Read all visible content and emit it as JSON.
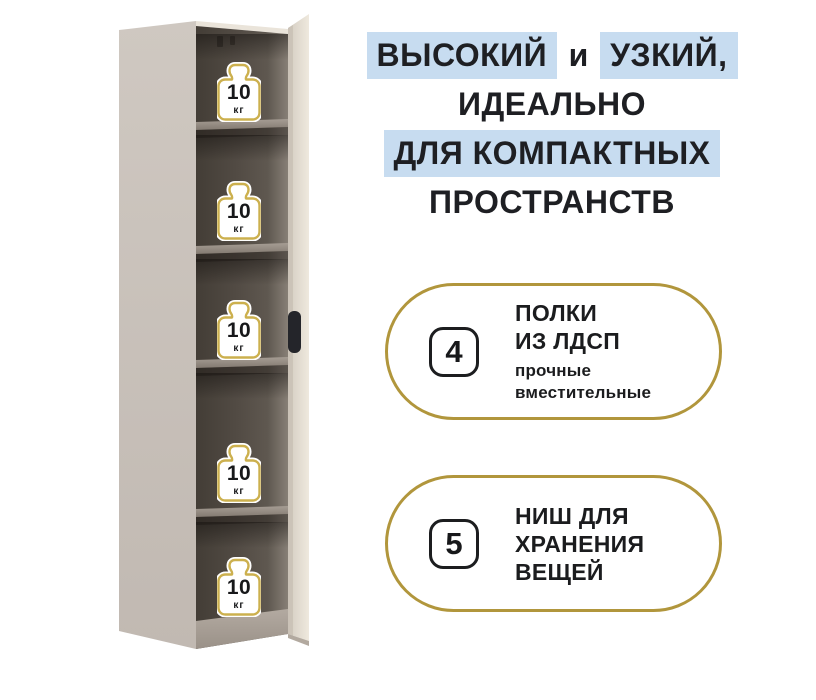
{
  "page": {
    "background_color": "#ffffff",
    "accent_gold": "#b1963c",
    "highlight_blue": "#c7dcf0",
    "text_color": "#1e1f23"
  },
  "headline": {
    "segments": [
      {
        "text": "ВЫСОКИЙ",
        "highlighted": true
      },
      {
        "text": "и",
        "highlighted": false
      },
      {
        "text": "УЗКИЙ,",
        "highlighted": true
      },
      {
        "text": "ИДЕАЛЬНО",
        "highlighted": false
      },
      {
        "text": "ДЛЯ КОМПАКТНЫХ",
        "highlighted": true
      },
      {
        "text": "ПРОСТРАНСТВ",
        "highlighted": false
      }
    ]
  },
  "features": [
    {
      "count": "4",
      "title_lines": [
        "ПОЛКИ",
        "ИЗ ЛДСП"
      ],
      "subtitle_lines": [
        "прочные",
        "вместительные"
      ]
    },
    {
      "count": "5",
      "title_lines": [
        "НИШ ДЛЯ",
        "ХРАНЕНИЯ",
        "ВЕЩЕЙ"
      ],
      "subtitle_lines": []
    }
  ],
  "cabinet": {
    "colors": {
      "side_panel": "#c9c1ba",
      "door": "#e9e3d8",
      "interior_dark": "#433d36",
      "interior_light": "#877f76",
      "handle": "#24252a",
      "weight_outline_gold": "#ccb04e"
    },
    "weight_labels": [
      {
        "value": "10",
        "unit": "кг"
      },
      {
        "value": "10",
        "unit": "кг"
      },
      {
        "value": "10",
        "unit": "кг"
      },
      {
        "value": "10",
        "unit": "кг"
      },
      {
        "value": "10",
        "unit": "кг"
      }
    ]
  },
  "icons": {
    "weight": "kettlebell-weight-shape, white fill with gold outline"
  }
}
